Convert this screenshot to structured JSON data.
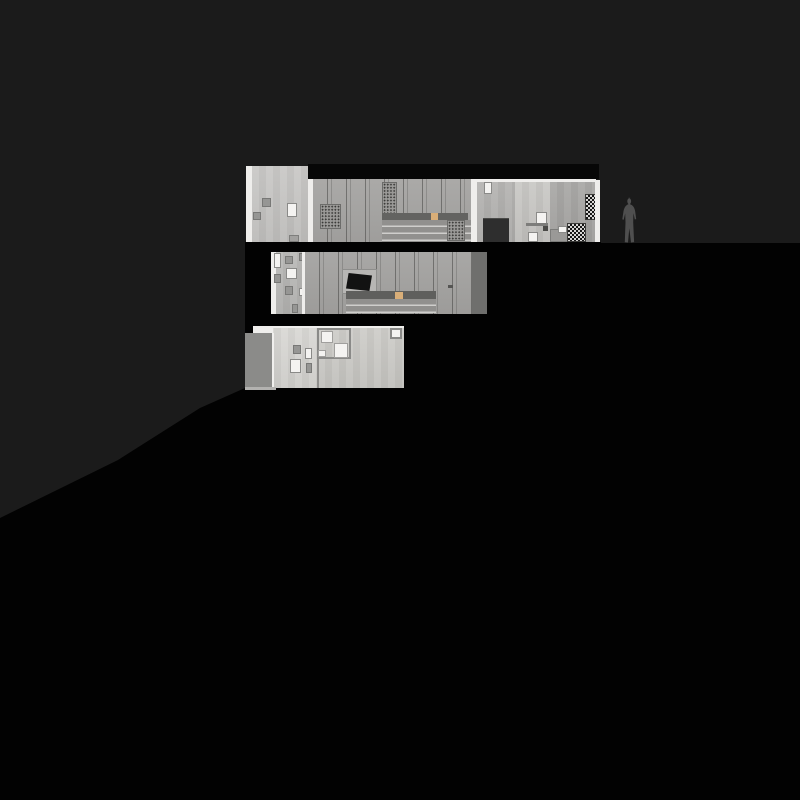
{
  "scene": {
    "kind": "architectural section drawing of a hillside house at night",
    "floors_count": 3,
    "colors": {
      "background": "#1b1b1b",
      "ground": "#020202",
      "roof_slab": "#070707",
      "wall_light": "#c8c7c5",
      "wall_medium": "#a7a6a4",
      "wall_interior_light": "#c9c8c5",
      "wall_interior_mid": "#b4b3b1",
      "wall_right": "#a8a7a5",
      "band_dark": "#636361",
      "band_dark_right": "#6f6f6d",
      "panel_gray": "#8b8b89",
      "accent_orange": "#d9ae78",
      "window_white": "#f4f3f1",
      "door_dark": "#2e2e2e",
      "screen_black": "#121212",
      "figure_gray": "#4f4f4f",
      "floor_lower_left": "#d9d8d4",
      "floor_lower_right": "#cdccc8"
    },
    "elements": {
      "upper_floor": "long top level with perforated panels, louver band, dark doorway and shelf",
      "middle_floor": "middle level with window cluster, recessed dark screen and louver band",
      "lower_floor": "lowest level with framed square window composition and gray service panel",
      "person": "gray human silhouette standing on grade right of the building",
      "terrain": "black hillside sloping down toward the lower left"
    }
  }
}
